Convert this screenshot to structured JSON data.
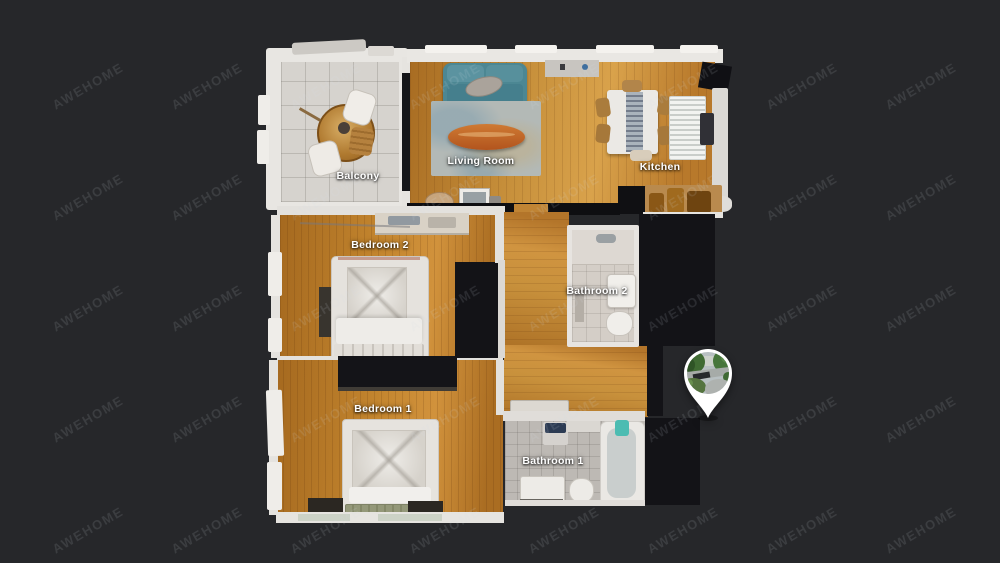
{
  "watermark": {
    "text": "AWEHOME"
  },
  "theme": {
    "background": "#26272a",
    "watermark_color": "rgba(214,220,230,0.12)",
    "floor_wood": "#c8913c",
    "tile_light": "#d6d3ce",
    "unscanned_dark": "#131317",
    "sofa_teal": "#4c8793",
    "coffee_table_orange": "#bd6127",
    "label_color": "#ffffff",
    "pin_color": "#ffffff"
  },
  "floorplan": {
    "rooms": [
      {
        "id": "balcony",
        "label": "Balcony",
        "x": 358,
        "y": 176
      },
      {
        "id": "living-room",
        "label": "Living Room",
        "x": 481,
        "y": 161
      },
      {
        "id": "kitchen",
        "label": "Kitchen",
        "x": 660,
        "y": 167
      },
      {
        "id": "bedroom-2",
        "label": "Bedroom 2",
        "x": 380,
        "y": 245
      },
      {
        "id": "bathroom-2",
        "label": "Bathroom 2",
        "x": 597,
        "y": 291
      },
      {
        "id": "bedroom-1",
        "label": "Bedroom 1",
        "x": 383,
        "y": 409
      },
      {
        "id": "bathroom-1",
        "label": "Bathroom 1",
        "x": 553,
        "y": 461
      }
    ]
  },
  "marker": {
    "icon": "location-pin",
    "photo": "street-scene-thumbnail",
    "x": 708,
    "y": 373
  }
}
